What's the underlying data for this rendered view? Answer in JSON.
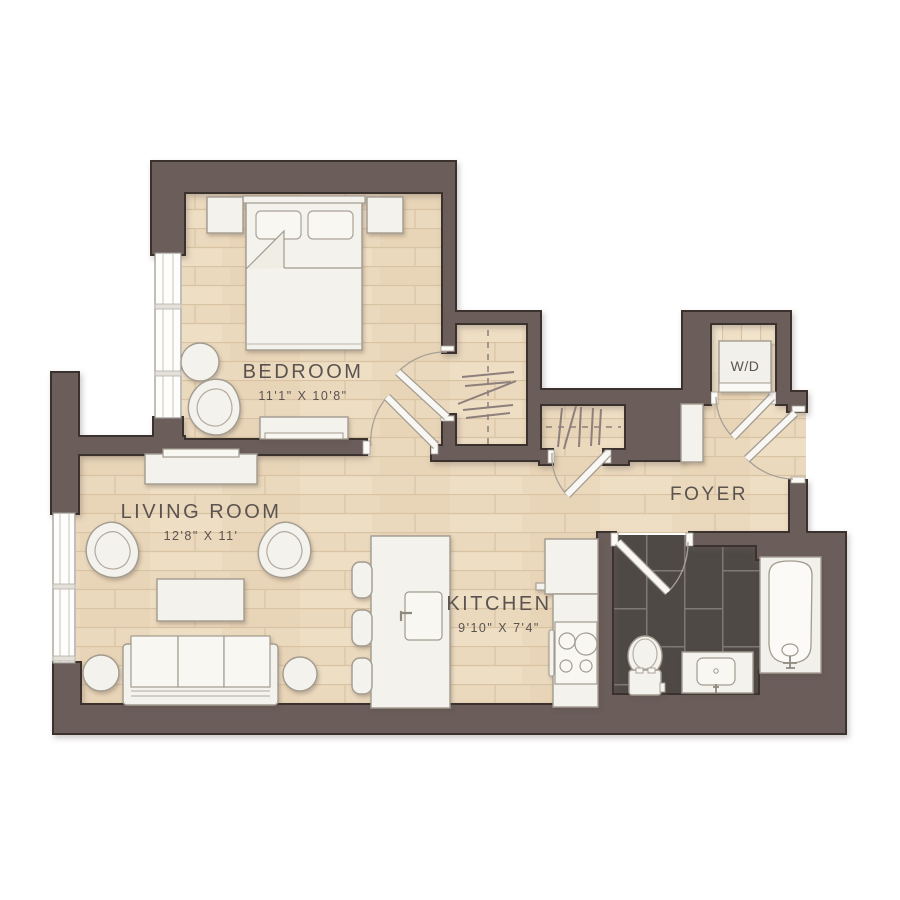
{
  "plan": {
    "type": "apartment-floor-plan",
    "rooms": {
      "bedroom": {
        "label": "BEDROOM",
        "dims": "11'1\" X 10'8\""
      },
      "living_room": {
        "label": "LIVING ROOM",
        "dims": "12'8\" X 11'"
      },
      "kitchen": {
        "label": "KITCHEN",
        "dims": "9'10\" X 7'4\""
      },
      "foyer": {
        "label": "FOYER"
      },
      "laundry": {
        "label": "W/D"
      }
    },
    "colors": {
      "wall": "#6b5d5a",
      "wall_outline": "#3a322e",
      "wood_floor": "#ebd9bd",
      "wood_plank_line": "#d9c3a3",
      "bath_tile": "#4e4945",
      "tile_grout": "#7f7973",
      "furniture": "#f4f2ec",
      "furniture_stroke": "#a29b90",
      "label_text": "#5b5350",
      "background": "#ffffff"
    }
  }
}
